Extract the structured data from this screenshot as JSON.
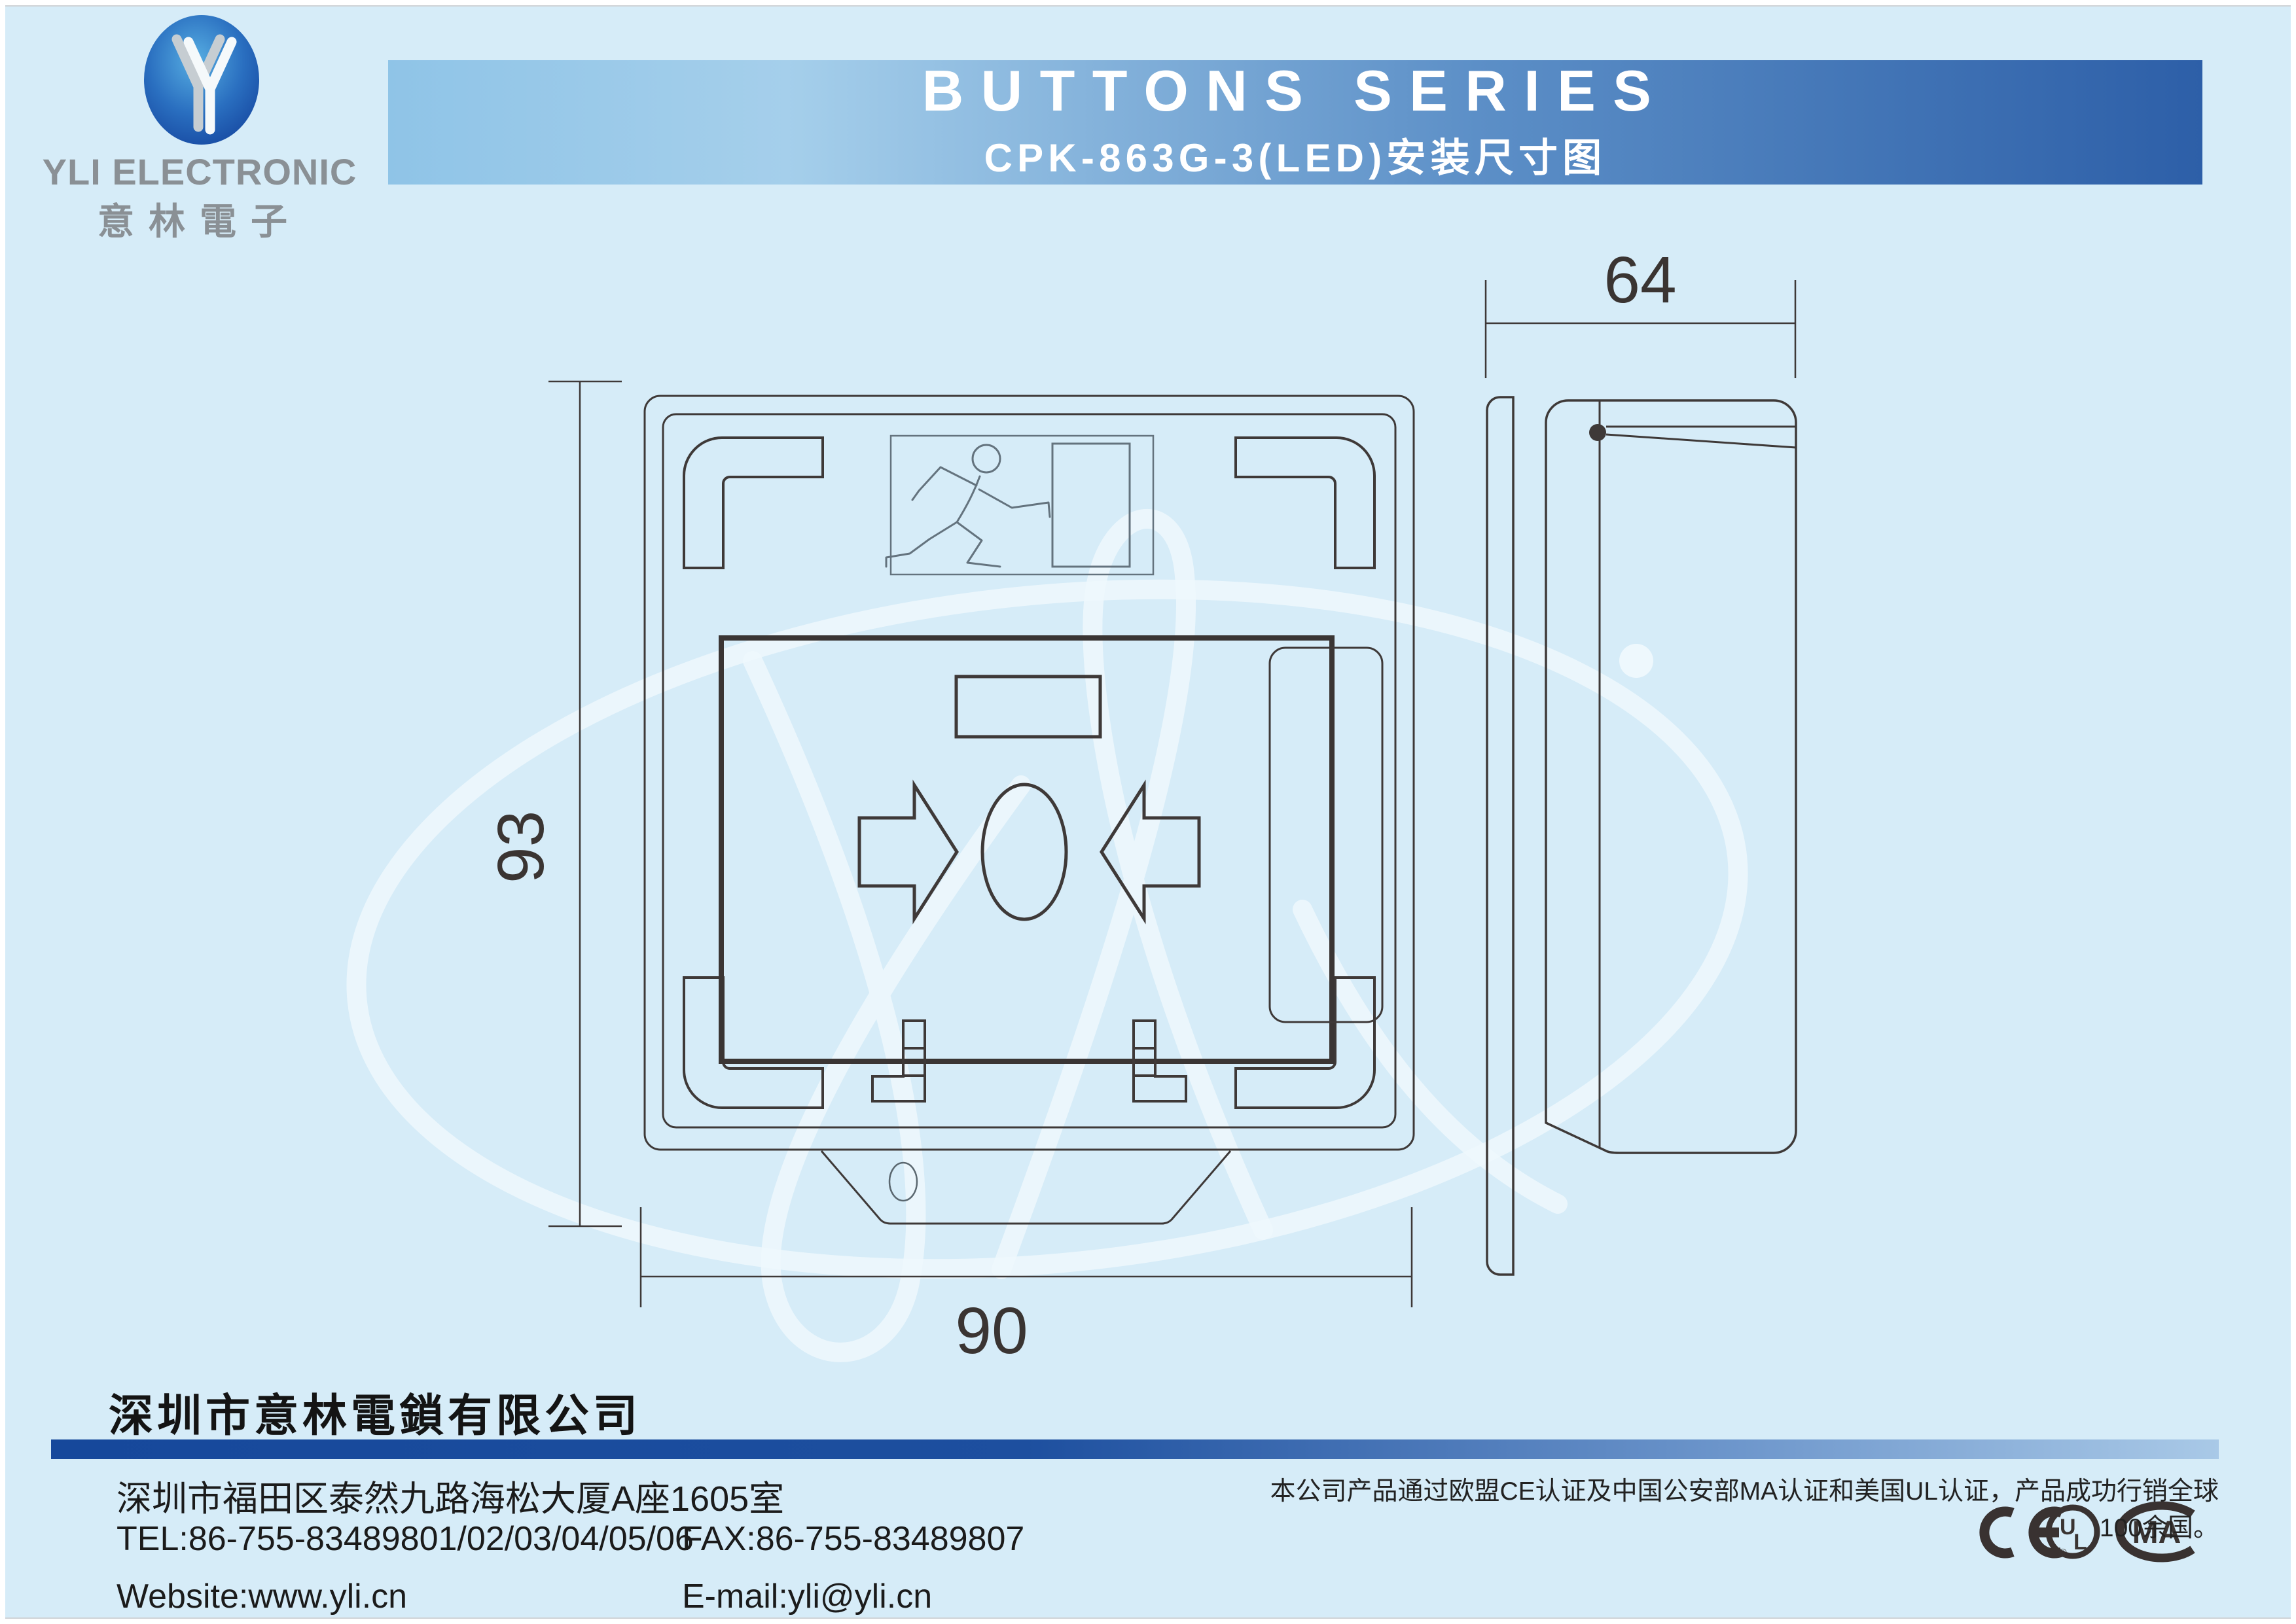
{
  "page": {
    "background": "#d6ecf8",
    "line_color": "#3e3938"
  },
  "logo": {
    "company_en": "YLI ELECTRONIC",
    "company_cn": "意林電子",
    "oval_outer_color": "#15459e",
    "oval_inner_color": "#57aee2"
  },
  "banner": {
    "title": "BUTTONS SERIES",
    "subtitle": "CPK-863G-3(LED)安装尺寸图",
    "gradient_left": "#8fc4e7",
    "gradient_right": "#2d5fa8",
    "text_color": "#ffffff"
  },
  "drawing": {
    "front_view": {
      "width_dim": "90",
      "height_dim": "93"
    },
    "side_view": {
      "depth_dim": "64"
    }
  },
  "footer": {
    "company_name": "深圳市意林電鎖有限公司",
    "address": "深圳市福田区泰然九路海松大厦A座1605室",
    "tel": "TEL:86-755-83489801/02/03/04/05/06",
    "fax": "FAX:86-755-83489807",
    "website": "Website:www.yli.cn",
    "email": "E-mail:yli@yli.cn",
    "cert_note": "本公司产品通过欧盟CE认证及中国公安部MA认证和美国UL认证，产品成功行销全球100余国。",
    "bar_gradient_left": "#16489b",
    "bar_gradient_right": "#a9c9e7"
  },
  "cert_marks": {
    "ce": "CE",
    "ul": "UL",
    "ma": "MA",
    "registered": "®"
  }
}
